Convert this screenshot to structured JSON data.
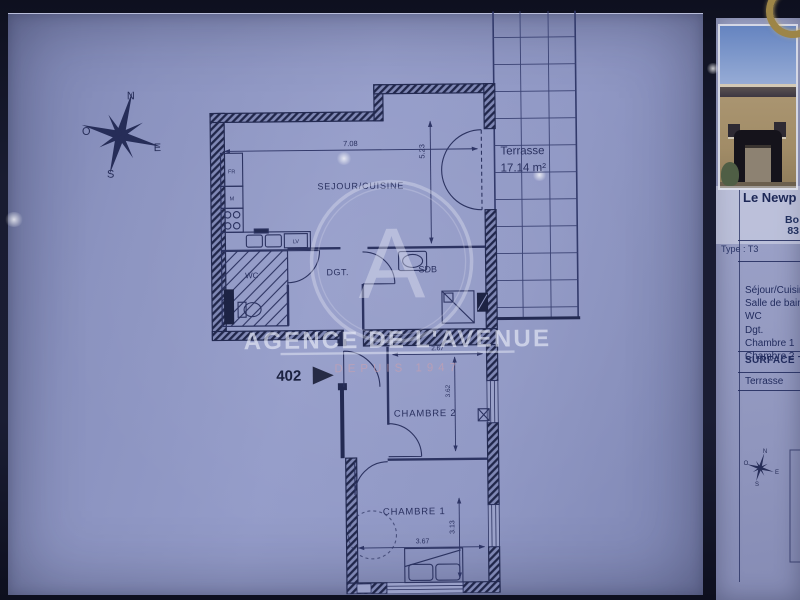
{
  "compass": {
    "n": "N",
    "o": "O",
    "e": "E",
    "s": "S"
  },
  "plan": {
    "unit_number": "402",
    "rooms": {
      "sejour": {
        "label": "SEJOUR/CUISINE",
        "width": "7.08",
        "depth": "5.23"
      },
      "terrasse": {
        "label": "Terrasse",
        "area": "17.14 m²"
      },
      "wc": {
        "label": "WC"
      },
      "degagement": {
        "label": "DGT."
      },
      "sdb": {
        "label": "SDB"
      },
      "chambre2": {
        "label": "CHAMBRE 2",
        "width": "2.67",
        "depth": "3.62"
      },
      "chambre1": {
        "label": "CHAMBRE 1",
        "width": "3.67",
        "depth": "3.13"
      }
    },
    "kitchen_labels": {
      "fridge": "FR",
      "m": "M",
      "dishwasher": "LV"
    },
    "watermark": {
      "monogram": "A",
      "name": "AGENCE DE L'AVENUE",
      "tagline": "DEPUIS 1947"
    }
  },
  "panel": {
    "title": "Le Newp",
    "address_line1": "Bo",
    "address_line2": "83",
    "type_row": "Type : T3",
    "room_list": [
      "Séjour/Cuisin",
      "Salle de bains",
      "WC",
      "Dgt.",
      "Chambre 1",
      "Chambre 2"
    ],
    "surface_heading": "SURFACE T",
    "terrace_row": "Terrasse"
  },
  "colors": {
    "paper": "#8a92bf",
    "ink": "#2a3160",
    "wall": "#232a52",
    "watermark": "#e8ebf7",
    "tagline": "#d4a0aa"
  }
}
